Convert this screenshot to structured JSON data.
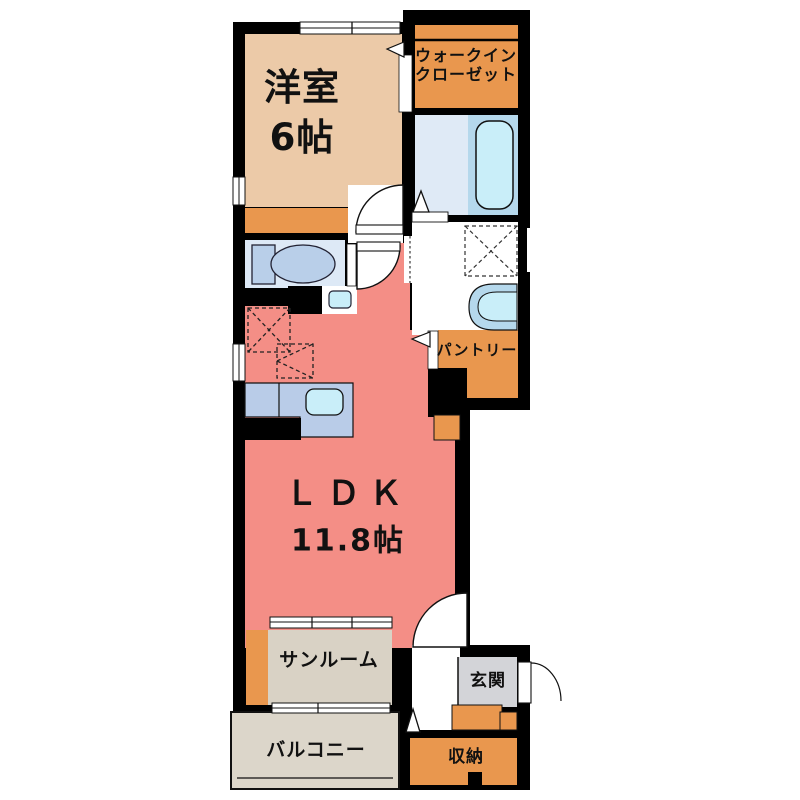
{
  "floorplan": {
    "rooms": {
      "western": {
        "label": "洋室",
        "size": "6帖"
      },
      "wic": {
        "label_line1": "ウォークイン",
        "label_line2": "クローゼット"
      },
      "pantry": {
        "label": "パントリー"
      },
      "ldk": {
        "label": "ＬＤＫ",
        "size": "11.8帖"
      },
      "sunroom": {
        "label": "サンルーム"
      },
      "balcony": {
        "label": "バルコニー"
      },
      "entrance": {
        "label": "玄関"
      },
      "storage": {
        "label": "収納"
      }
    },
    "colors": {
      "wall": "#000000",
      "western_floor": "#eccaa8",
      "closet_orange": "#e9974e",
      "ldk_floor": "#f48e86",
      "toilet_floor": "#dde9f6",
      "bath_floor": "#dfeaf6",
      "tub_zone": "#b5d8ec",
      "fixture_fill": "#c9eef9",
      "toilet_fixture": "#b9cfe9",
      "kitchen_counter": "#b9cce8",
      "sunroom_floor": "#d9d2c5",
      "balcony_floor": "#dcd6ca",
      "entrance_floor": "#d3d4d8"
    },
    "fixtures": {
      "bathtub": "bathtub",
      "toilet": "toilet",
      "hand_basin": "hand-basin",
      "wash_basin": "wash-basin",
      "kitchen_sink": "kitchen-sink",
      "washing_machine_space": "washing-machine-space",
      "refrigerator_space": "refrigerator-space",
      "cupboard_space": "cupboard-space"
    }
  }
}
